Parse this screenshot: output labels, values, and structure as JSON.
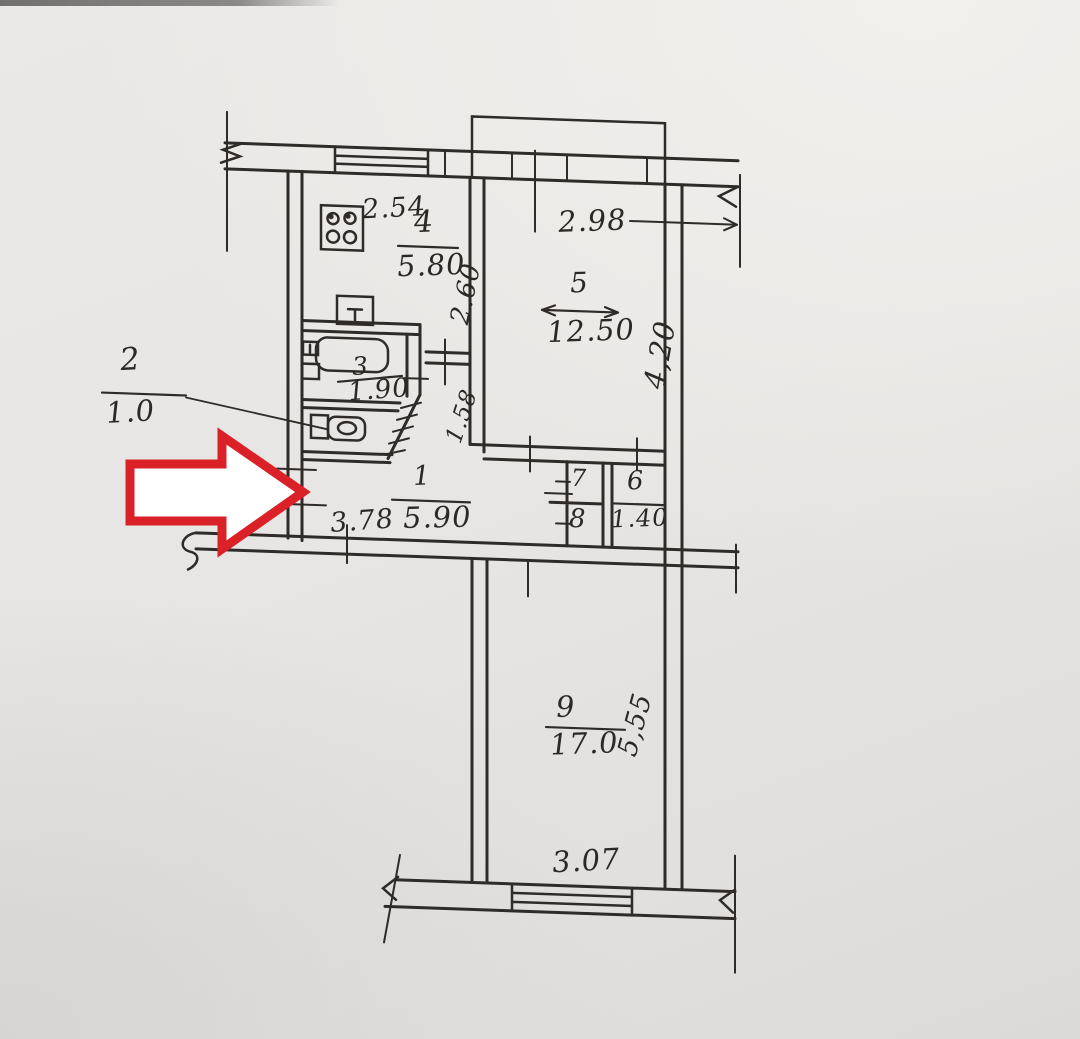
{
  "document_kind": "hand-drawn apartment floor plan photo with red pointer arrow",
  "palette": {
    "paper": "#e9e7e5",
    "ink": "#2e2b28",
    "arrow_outline_red": "#da2127",
    "arrow_fill": "#ffffff"
  },
  "icons": {
    "pointer": "red-arrow-right-icon",
    "kitchen_fixture": "stove-icon",
    "bath_fixtures": [
      "sink-icon",
      "bathtub-icon"
    ],
    "wc_fixture": "toilet-icon"
  },
  "plan": {
    "rooms": {
      "kitchen": {
        "number": "4",
        "area": "5.80",
        "width": "2.54",
        "depth": "2.60"
      },
      "living": {
        "number": "5",
        "area": "12.50",
        "width": "2.98",
        "depth": "4,20"
      },
      "bathroom": {
        "number": "3",
        "area": "1.90"
      },
      "wc": {
        "number": "2",
        "area": "1.0"
      },
      "hallway": {
        "number": "1",
        "area": "5.90",
        "width": "3.78",
        "passage_depth": "1.58"
      },
      "closet_upper": {
        "number": "7"
      },
      "closet_lower": {
        "number": "8"
      },
      "storage": {
        "number": "6",
        "area": "1.40"
      },
      "bedroom": {
        "number": "9",
        "area": "17.0",
        "width": "3.07",
        "depth": "5,55"
      }
    }
  }
}
